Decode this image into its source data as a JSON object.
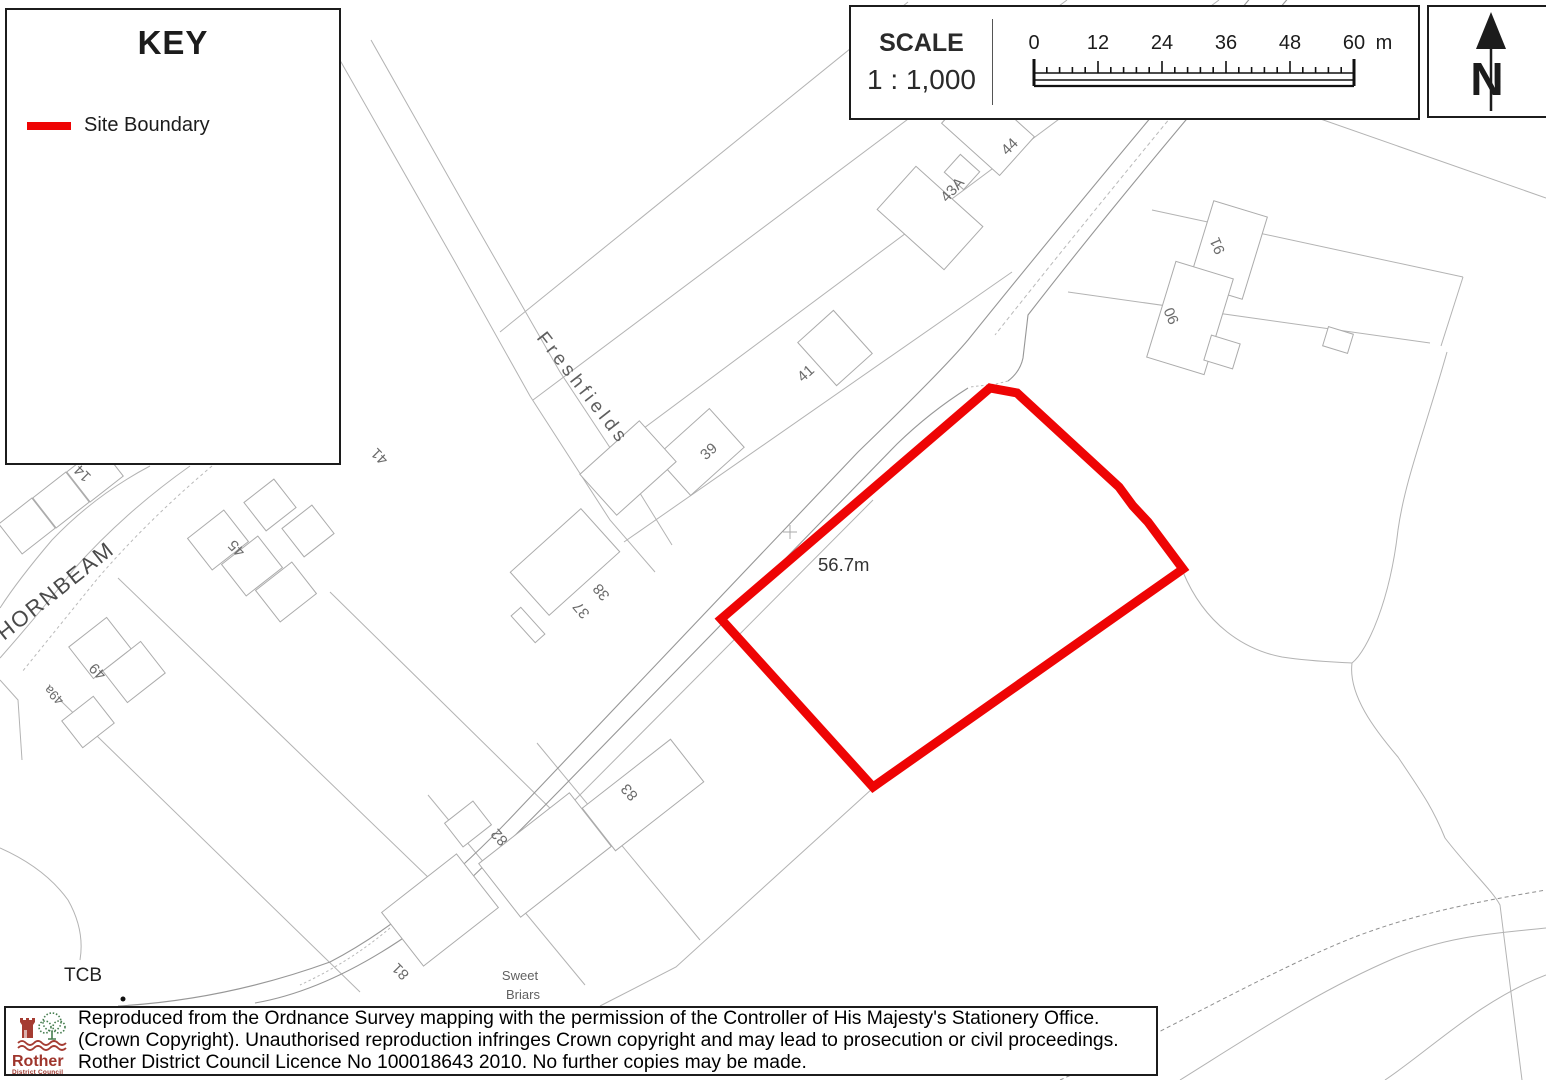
{
  "key_panel": {
    "title": "KEY",
    "items": [
      {
        "label": "Site Boundary",
        "color": "#ee0404"
      }
    ]
  },
  "scale_panel": {
    "title": "SCALE",
    "ratio": "1 : 1,000",
    "ticks": [
      "0",
      "12",
      "24",
      "36",
      "48",
      "60"
    ],
    "unit": "m"
  },
  "north_panel": {
    "label": "N"
  },
  "map": {
    "site_boundary": {
      "color": "#ee0404",
      "points": "990,388 1017,393 1119,487 1133,506 1148,522 1183,569 873,787 721,619"
    },
    "spot_height": "56.7m",
    "labels": [
      {
        "text": "Freshfields",
        "x": 536,
        "y": 338,
        "rot": 52,
        "size": 19,
        "ls": 4,
        "fill": "#5f5f5f",
        "anchor": "start"
      },
      {
        "text": "HORNBEAM",
        "x": 4,
        "y": 641,
        "rot": -38.5,
        "size": 22,
        "ls": 2,
        "fill": "#4a4a4a",
        "anchor": "start"
      },
      {
        "text": "56.7m",
        "x": 818,
        "y": 571,
        "rot": 0,
        "size": 18.5,
        "fill": "#333",
        "anchor": "start"
      },
      {
        "text": "TCB",
        "x": 64,
        "y": 981,
        "rot": 0,
        "size": 19,
        "fill": "#222",
        "anchor": "start"
      },
      {
        "text": "Sweet",
        "x": 520,
        "y": 980,
        "rot": 0,
        "size": 13,
        "fill": "#606060"
      },
      {
        "text": "Briars",
        "x": 523,
        "y": 999,
        "rot": 0,
        "size": 13,
        "fill": "#606060"
      },
      {
        "text": "39",
        "x": 712,
        "y": 455,
        "rot": -42,
        "size": 15,
        "fill": "#6b6b6b"
      },
      {
        "text": "41",
        "x": 809,
        "y": 377,
        "rot": -42,
        "size": 15,
        "fill": "#6b6b6b"
      },
      {
        "text": "43A",
        "x": 956,
        "y": 193,
        "rot": -48,
        "size": 15,
        "fill": "#6b6b6b"
      },
      {
        "text": "44",
        "x": 1013,
        "y": 150,
        "rot": -45,
        "size": 15,
        "fill": "#6b6b6b"
      },
      {
        "text": "37",
        "x": 585,
        "y": 607,
        "rot": 230,
        "size": 15,
        "fill": "#6b6b6b"
      },
      {
        "text": "38",
        "x": 605,
        "y": 589,
        "rot": 230,
        "size": 15,
        "fill": "#6b6b6b"
      },
      {
        "text": "41",
        "x": 383,
        "y": 453,
        "rot": 225,
        "size": 15,
        "fill": "#6b6b6b"
      },
      {
        "text": "45",
        "x": 240,
        "y": 545,
        "rot": 225,
        "size": 15,
        "fill": "#6b6b6b"
      },
      {
        "text": "14",
        "x": 86,
        "y": 470,
        "rot": 225,
        "size": 15,
        "fill": "#6b6b6b"
      },
      {
        "text": "49",
        "x": 101,
        "y": 668,
        "rot": 225,
        "size": 15,
        "fill": "#6b6b6b"
      },
      {
        "text": "49a",
        "x": 57,
        "y": 692,
        "rot": 225,
        "size": 13,
        "fill": "#6b6b6b"
      },
      {
        "text": "81",
        "x": 404,
        "y": 968,
        "rot": 225,
        "size": 15,
        "fill": "#6b6b6b"
      },
      {
        "text": "82",
        "x": 503,
        "y": 834,
        "rot": 228,
        "size": 15,
        "fill": "#6b6b6b"
      },
      {
        "text": "83",
        "x": 633,
        "y": 789,
        "rot": 228,
        "size": 15,
        "fill": "#6b6b6b"
      },
      {
        "text": "91",
        "x": 1222,
        "y": 244,
        "rot": 247,
        "size": 15,
        "fill": "#6b6b6b"
      },
      {
        "text": "90",
        "x": 1176,
        "y": 314,
        "rot": 247,
        "size": 15,
        "fill": "#6b6b6b"
      }
    ],
    "houses": [
      {
        "cx": 700,
        "cy": 452,
        "w": 72,
        "h": 52,
        "a": -42
      },
      {
        "cx": 628,
        "cy": 468,
        "w": 80,
        "h": 55,
        "a": -42
      },
      {
        "cx": 565,
        "cy": 562,
        "w": 95,
        "h": 58,
        "a": -42
      },
      {
        "cx": 528,
        "cy": 625,
        "w": 13,
        "h": 36,
        "a": -42
      },
      {
        "cx": 835,
        "cy": 348,
        "w": 48,
        "h": 58,
        "a": -42
      },
      {
        "cx": 930,
        "cy": 218,
        "w": 58,
        "h": 90,
        "a": -48
      },
      {
        "cx": 962,
        "cy": 172,
        "w": 24,
        "h": 26,
        "a": -48
      },
      {
        "cx": 988,
        "cy": 130,
        "w": 52,
        "h": 78,
        "a": -48
      },
      {
        "cx": 1228,
        "cy": 250,
        "w": 56,
        "h": 86,
        "a": 17
      },
      {
        "cx": 1190,
        "cy": 318,
        "w": 60,
        "h": 100,
        "a": 17
      },
      {
        "cx": 1222,
        "cy": 352,
        "w": 30,
        "h": 26,
        "a": 17
      },
      {
        "cx": 1338,
        "cy": 340,
        "w": 26,
        "h": 20,
        "a": 17
      },
      {
        "cx": 270,
        "cy": 505,
        "w": 38,
        "h": 36,
        "a": -38
      },
      {
        "cx": 308,
        "cy": 531,
        "w": 38,
        "h": 36,
        "a": -38
      },
      {
        "cx": 218,
        "cy": 540,
        "w": 46,
        "h": 40,
        "a": -38
      },
      {
        "cx": 252,
        "cy": 566,
        "w": 46,
        "h": 40,
        "a": -38
      },
      {
        "cx": 286,
        "cy": 592,
        "w": 46,
        "h": 40,
        "a": -38
      },
      {
        "cx": 100,
        "cy": 648,
        "w": 48,
        "h": 40,
        "a": -38
      },
      {
        "cx": 134,
        "cy": 672,
        "w": 48,
        "h": 40,
        "a": -38
      },
      {
        "cx": 88,
        "cy": 722,
        "w": 40,
        "h": 34,
        "a": -38
      },
      {
        "cx": 95,
        "cy": 474,
        "w": 42,
        "h": 38,
        "a": -38
      },
      {
        "cx": 61,
        "cy": 500,
        "w": 42,
        "h": 38,
        "a": -38
      },
      {
        "cx": 27,
        "cy": 526,
        "w": 42,
        "h": 38,
        "a": -38
      },
      {
        "cx": 545,
        "cy": 855,
        "w": 115,
        "h": 68,
        "a": -38
      },
      {
        "cx": 468,
        "cy": 824,
        "w": 36,
        "h": 30,
        "a": -38
      },
      {
        "cx": 643,
        "cy": 795,
        "w": 112,
        "h": 54,
        "a": -38
      },
      {
        "cx": 440,
        "cy": 910,
        "w": 95,
        "h": 68,
        "a": -38
      }
    ]
  },
  "footer": {
    "logo_word": "Rother",
    "logo_sub": "District Council",
    "lines": [
      "Reproduced from the Ordnance Survey mapping with the permission of the Controller of His Majesty's Stationery Office.",
      "(Crown Copyright). Unauthorised reproduction infringes Crown copyright and may lead to prosecution or civil proceedings.",
      "Rother District Council Licence No 100018643 2010. No further copies may be made."
    ]
  }
}
